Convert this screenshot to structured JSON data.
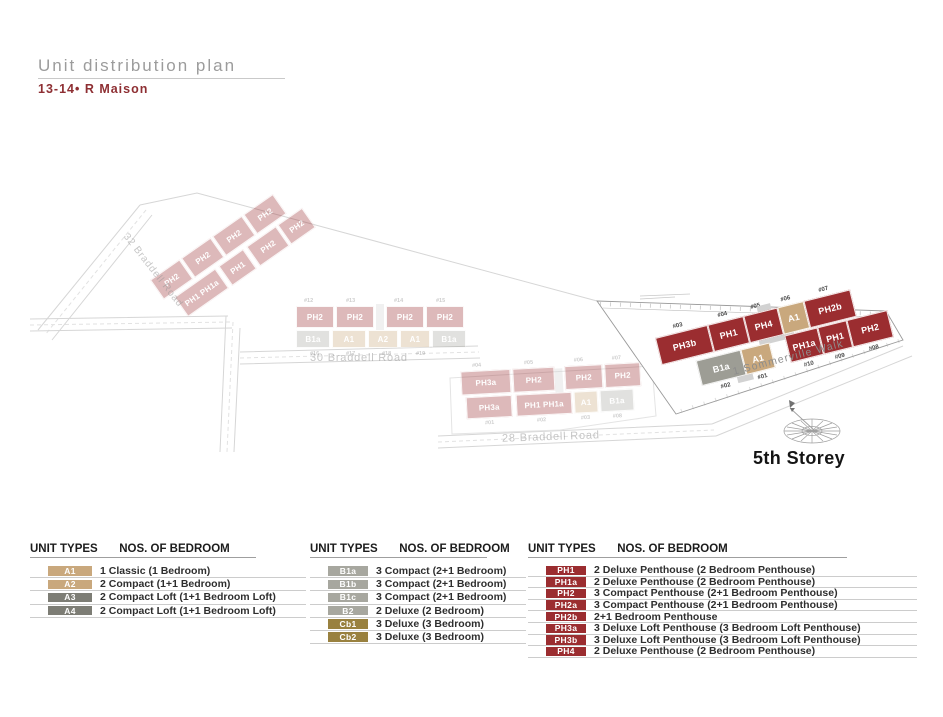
{
  "header": {
    "title": "Unit distribution plan",
    "subtitle": "13-14• R Maison"
  },
  "site_plan": {
    "storey_label": "5th Storey",
    "highlighted_building": {
      "road_label": "1 Sommerville Walk",
      "top_units": [
        {
          "no": "#03",
          "code": "PH3b",
          "color": "#9b2d30"
        },
        {
          "no": "#04",
          "code": "PH1",
          "color": "#9b2d30"
        },
        {
          "no": "#05",
          "code": "PH4",
          "color": "#9b2d30"
        },
        {
          "no": "#06",
          "code": "A1",
          "color": "#c9a87d"
        },
        {
          "no": "#07",
          "code": "PH2b",
          "color": "#9b2d30"
        }
      ],
      "bottom_units": [
        {
          "no": "#02",
          "code": "B1a",
          "color": "#9d9d95"
        },
        {
          "no": "#01",
          "code": "A1",
          "color": "#c9a87d"
        },
        {
          "no": "#10",
          "code": "PH1a",
          "color": "#9b2d30"
        },
        {
          "no": "#09",
          "code": "PH1",
          "color": "#9b2d30"
        },
        {
          "no": "#08",
          "code": "PH2",
          "color": "#9b2d30"
        }
      ]
    },
    "faded_clusters": [
      {
        "road_label": "32 Braddell Road",
        "row1": [
          "PH2",
          "PH2",
          "PH2",
          "PH2"
        ],
        "row2": [
          "PH1 PH1a",
          "PH1",
          "PH2",
          "PH2"
        ]
      },
      {
        "road_label": "30 Braddell Road",
        "top_units": [
          {
            "no": "#12",
            "code": "PH2"
          },
          {
            "no": "#13",
            "code": "PH2"
          },
          {
            "no": "#14",
            "code": "PH2"
          },
          {
            "no": "#15",
            "code": "PH2"
          }
        ],
        "bottom_units": [
          {
            "no": "#16",
            "code": "B1a"
          },
          {
            "no": "#17",
            "code": "A1"
          },
          {
            "no": "#18",
            "code": "A2"
          },
          {
            "no": "#19",
            "code": "A1"
          },
          {
            "no": "",
            "code": "B1a"
          }
        ]
      },
      {
        "road_label": "28 Braddell Road",
        "top_units": [
          {
            "no": "#04",
            "code": "PH3a"
          },
          {
            "no": "#05",
            "code": "PH2"
          },
          {
            "no": "#06",
            "code": "PH2"
          },
          {
            "no": "#07",
            "code": "PH2"
          }
        ],
        "bottom_units": [
          {
            "no": "#01",
            "code": "PH3a"
          },
          {
            "no": "#02",
            "code": "PH1 PH1a"
          },
          {
            "no": "#03",
            "code": "A1"
          },
          {
            "no": "#08",
            "code": "B1a"
          }
        ]
      }
    ]
  },
  "legend": {
    "columns": [
      {
        "headers": [
          "UNIT TYPES",
          "NOS. OF BEDROOM"
        ],
        "rows": [
          {
            "code": "A1",
            "color": "#c9a87d",
            "desc": "1 Classic (1 Bedroom)"
          },
          {
            "code": "A2",
            "color": "#c9a87d",
            "desc": "2 Compact (1+1 Bedroom)"
          },
          {
            "code": "A3",
            "color": "#7d7d75",
            "desc": "2 Compact Loft (1+1 Bedroom Loft)"
          },
          {
            "code": "A4",
            "color": "#7d7d75",
            "desc": "2 Compact Loft (1+1 Bedroom Loft)"
          }
        ]
      },
      {
        "headers": [
          "UNIT TYPES",
          "NOS. OF BEDROOM"
        ],
        "rows": [
          {
            "code": "B1a",
            "color": "#a7a79f",
            "desc": "3 Compact (2+1 Bedroom)"
          },
          {
            "code": "B1b",
            "color": "#a7a79f",
            "desc": "3 Compact (2+1 Bedroom)"
          },
          {
            "code": "B1c",
            "color": "#a7a79f",
            "desc": "3 Compact (2+1 Bedroom)"
          },
          {
            "code": "B2",
            "color": "#a7a79f",
            "desc": "2 Deluxe (2 Bedroom)"
          },
          {
            "code": "Cb1",
            "color": "#99813f",
            "desc": "3 Deluxe (3 Bedroom)"
          },
          {
            "code": "Cb2",
            "color": "#99813f",
            "desc": "3 Deluxe (3 Bedroom)"
          }
        ]
      },
      {
        "headers": [
          "UNIT TYPES",
          "NOS. OF BEDROOM"
        ],
        "rows": [
          {
            "code": "PH1",
            "color": "#9b2d30",
            "desc": "2 Deluxe Penthouse (2 Bedroom Penthouse)"
          },
          {
            "code": "PH1a",
            "color": "#9b2d30",
            "desc": "2 Deluxe Penthouse (2 Bedroom Penthouse)"
          },
          {
            "code": "PH2",
            "color": "#9b2d30",
            "desc": "3 Compact Penthouse (2+1 Bedroom Penthouse)"
          },
          {
            "code": "PH2a",
            "color": "#9b2d30",
            "desc": "3 Compact Penthouse (2+1 Bedroom Penthouse)"
          },
          {
            "code": "PH2b",
            "color": "#9b2d30",
            "desc": "2+1 Bedroom Penthouse"
          },
          {
            "code": "PH3a",
            "color": "#9b2d30",
            "desc": "3 Deluxe Loft Penthouse (3 Bedroom Loft Penthouse)"
          },
          {
            "code": "PH3b",
            "color": "#9b2d30",
            "desc": "3 Deluxe Loft Penthouse (3 Bedroom Loft Penthouse)"
          },
          {
            "code": "PH4",
            "color": "#9b2d30",
            "desc": "2 Deluxe Penthouse (2 Bedroom Penthouse)"
          }
        ]
      }
    ]
  },
  "colors": {
    "penthouse_red": "#9b2d30",
    "tan": "#c9a87d",
    "gray": "#7d7d75",
    "light_gray": "#a7a79f",
    "olive": "#99813f",
    "title_gray": "#9c9c9c",
    "subtitle_red": "#8e2f33"
  }
}
